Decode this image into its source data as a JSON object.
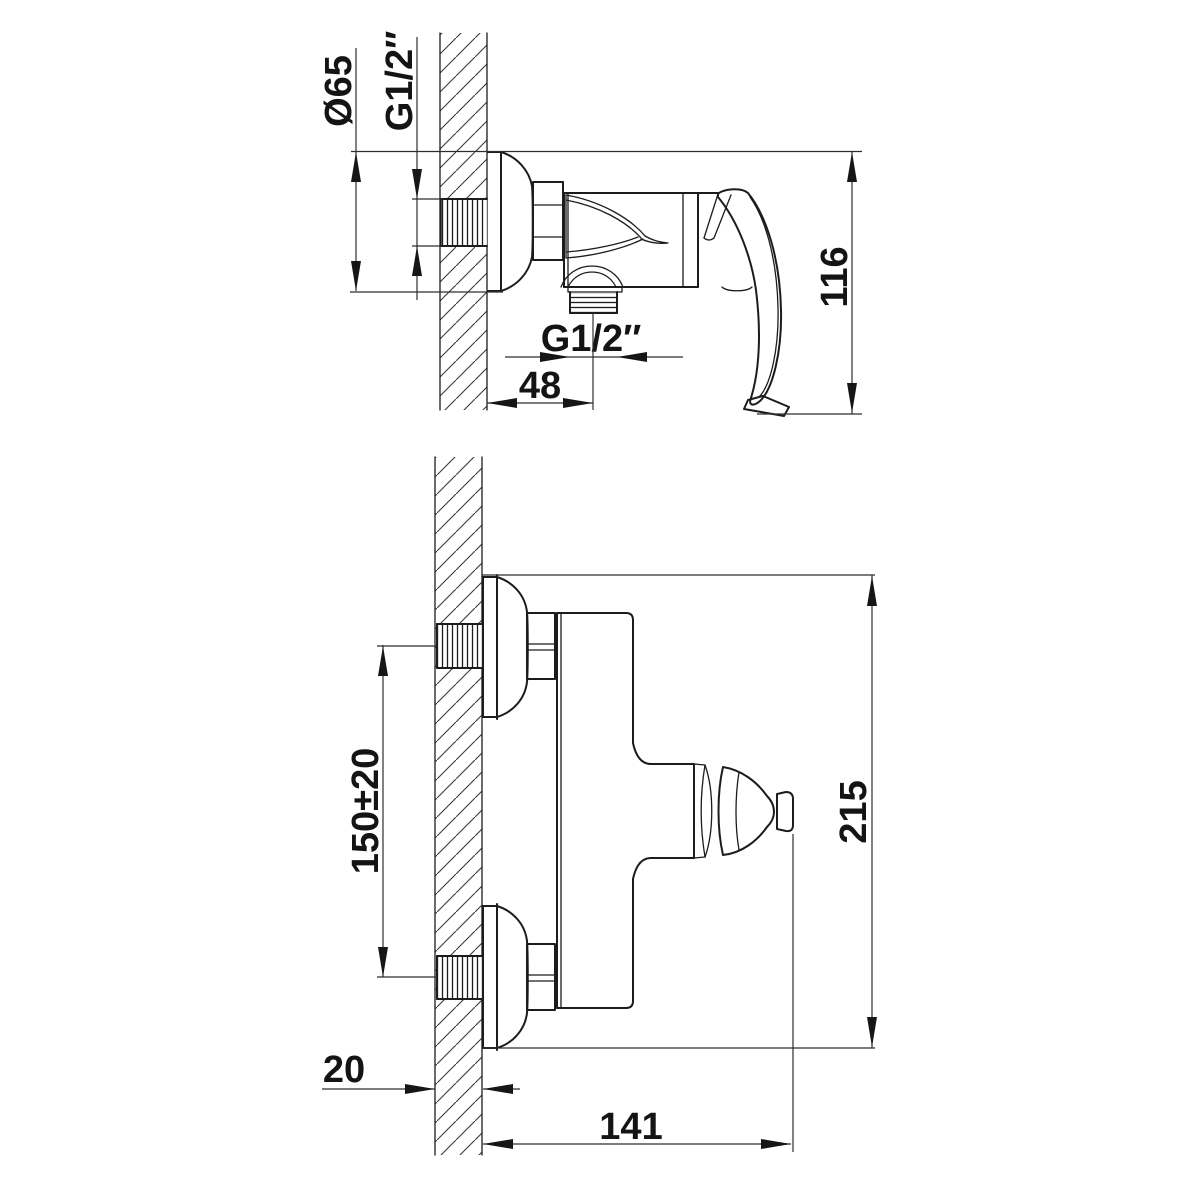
{
  "drawing": {
    "title": "Wall-mounted shower mixer installation drawing",
    "background_color": "#ffffff",
    "line_color": "#1c1c1c",
    "views": [
      {
        "id": "top-view",
        "description": "side profile view of mixer with lever handle and bottom outlet"
      },
      {
        "id": "front-view",
        "description": "elevation view with two wall inlets and handle"
      }
    ]
  },
  "labels": {
    "escutcheon_diameter": "Ø65",
    "inlet_thread": "G1/2″",
    "body_height": "116",
    "outlet_thread": "G1/2″",
    "outlet_offset": "48",
    "inlet_spacing": "150±20",
    "overall_height": "215",
    "wall_thickness": "20",
    "reach": "141"
  }
}
